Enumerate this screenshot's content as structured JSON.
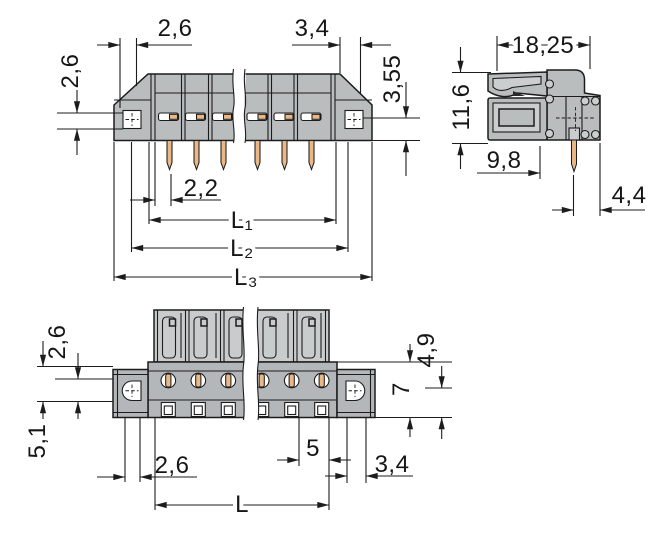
{
  "dims": {
    "front": {
      "top_left": "2,6",
      "top_right": "3,4",
      "left_height": "2,6",
      "right_height": "3,55",
      "pin_offset": "2,2",
      "l1": "L₁",
      "l2": "L₂",
      "l3": "L₃"
    },
    "side": {
      "total_width": "18,25",
      "total_height": "11,6",
      "depth": "9,8",
      "pin_to_edge": "4,4"
    },
    "bottom": {
      "left_upper": "2,6",
      "left_lower": "5,1",
      "slot_left": "2,6",
      "pitch": "5",
      "slot_right": "3,4",
      "upper_height": "4,9",
      "total_height": "7",
      "length": "L"
    }
  },
  "colors": {
    "line": "#1c1c1c",
    "body": "#b9bdbe",
    "body_light": "#cbcecf",
    "housing": "#c9cccd",
    "band": "#b3b7b9",
    "copper": "#eab887",
    "background": "#ffffff"
  }
}
